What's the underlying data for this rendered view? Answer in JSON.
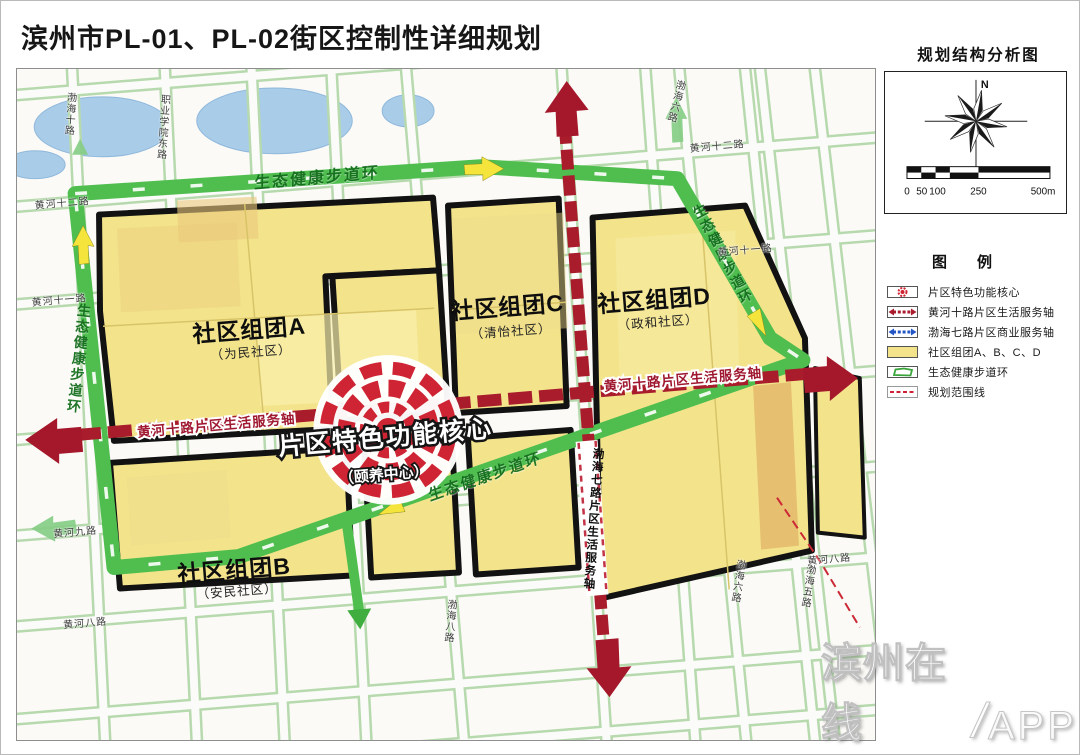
{
  "page": {
    "title": "滨州市PL-01、PL-02街区控制性详细规划",
    "diagram_title": "规划结构分析图",
    "watermark": {
      "brand": "滨州在线",
      "separator": "/",
      "suffix": "APP"
    }
  },
  "compass": {
    "north": "N"
  },
  "scalebar": {
    "ticks": [
      "0",
      "50",
      "100",
      "250",
      "500m"
    ]
  },
  "legend": {
    "title": "图　　例",
    "items": [
      {
        "label": "片区特色功能核心"
      },
      {
        "label": "黄河十路片区生活服务轴"
      },
      {
        "label": "渤海七路片区商业服务轴"
      },
      {
        "label": "社区组团A、B、C、D"
      },
      {
        "label": "生态健康步道环"
      },
      {
        "label": "规划范围线"
      }
    ]
  },
  "map": {
    "core": {
      "title": "片区特色功能核心",
      "subtitle": "（颐养中心）"
    },
    "clusters": [
      {
        "name": "社区组团A",
        "community": "（为民社区）"
      },
      {
        "name": "社区组团B",
        "community": "（安民社区）"
      },
      {
        "name": "社区组团C",
        "community": "（清怡社区）"
      },
      {
        "name": "社区组团D",
        "community": "（政和社区）"
      }
    ],
    "axes": {
      "horizontal_left": "黄河十路片区生活服务轴",
      "horizontal_right": "黄河十路片区生活服务轴",
      "vertical": "渤海七路片区生活服务轴"
    },
    "greenway": {
      "label": "生态健康步道环"
    },
    "road_labels": [
      "黄河十二路",
      "黄河十一路",
      "黄河九路",
      "黄河八路",
      "黄河十二路",
      "黄河十一路",
      "黄河八路",
      "渤海十路",
      "职业学院东路",
      "渤海六路",
      "渤海六路",
      "渤海五路",
      "渤海八路"
    ]
  },
  "colors": {
    "community_block": "#f3e48c",
    "greenway": "#4fbe4f",
    "service_axis_red": "#a81c2c",
    "commercial_axis_blue": "#2457c5",
    "core_red": "#cf2433",
    "water": "#a9cce8"
  }
}
